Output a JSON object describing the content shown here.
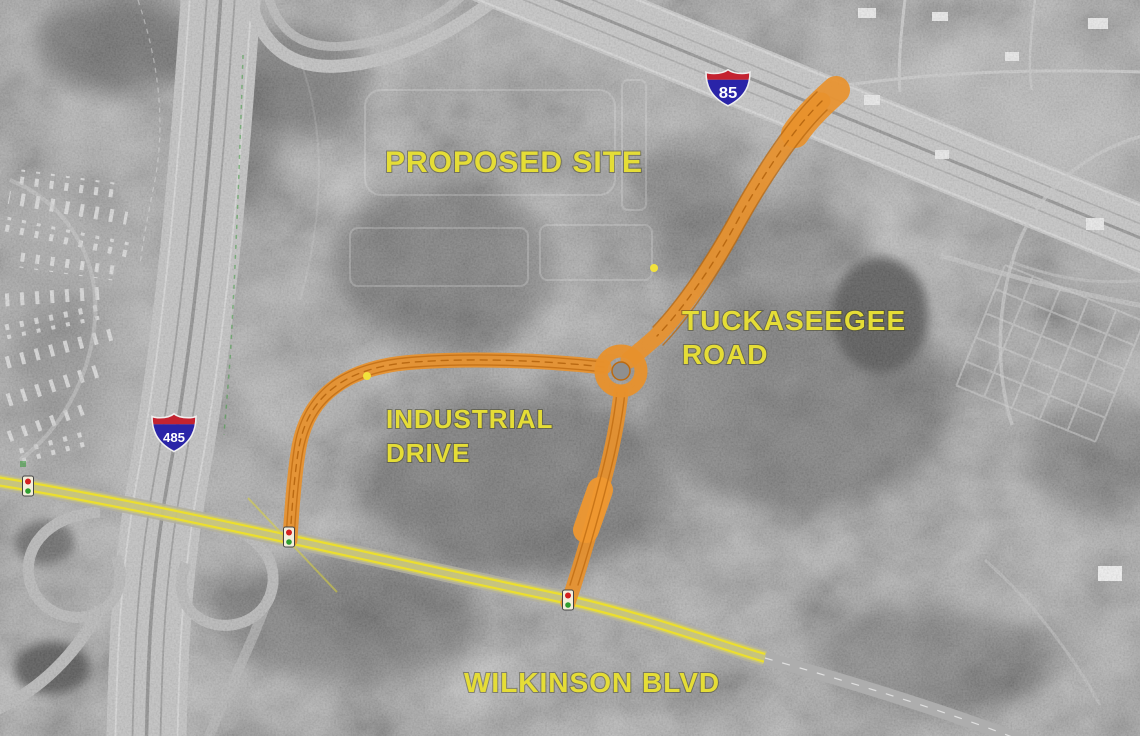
{
  "map": {
    "description": "Grayscale aerial photograph with proposed roadway improvements overlay",
    "labels": {
      "proposed_site": "PROPOSED SITE",
      "tuckaseegee_line1": "TUCKASEEGEE",
      "tuckaseegee_line2": "ROAD",
      "industrial_line1": "INDUSTRIAL",
      "industrial_line2": "DRIVE",
      "wilkinson": "WILKINSON BLVD"
    },
    "shields": {
      "i85": "85",
      "i485": "485"
    },
    "icons": {
      "traffic_signal": "traffic-light-icon",
      "roundabout": "roundabout-circle",
      "interstate_shield": "interstate-shield-icon"
    },
    "colors": {
      "label_yellow": "#e5dd36",
      "proposed_road_orange": "#e8912c",
      "proposed_road_orange_dark": "#bc6a10",
      "existing_road_yellow": "#e6e24e",
      "existing_road_edge_yellow": "#ecdf2e",
      "shield_blue": "#2a24a8",
      "shield_red": "#c42330",
      "signal_red": "#d42020",
      "signal_green": "#2f9e2f",
      "boundary_green": "#3f9b3f"
    }
  }
}
